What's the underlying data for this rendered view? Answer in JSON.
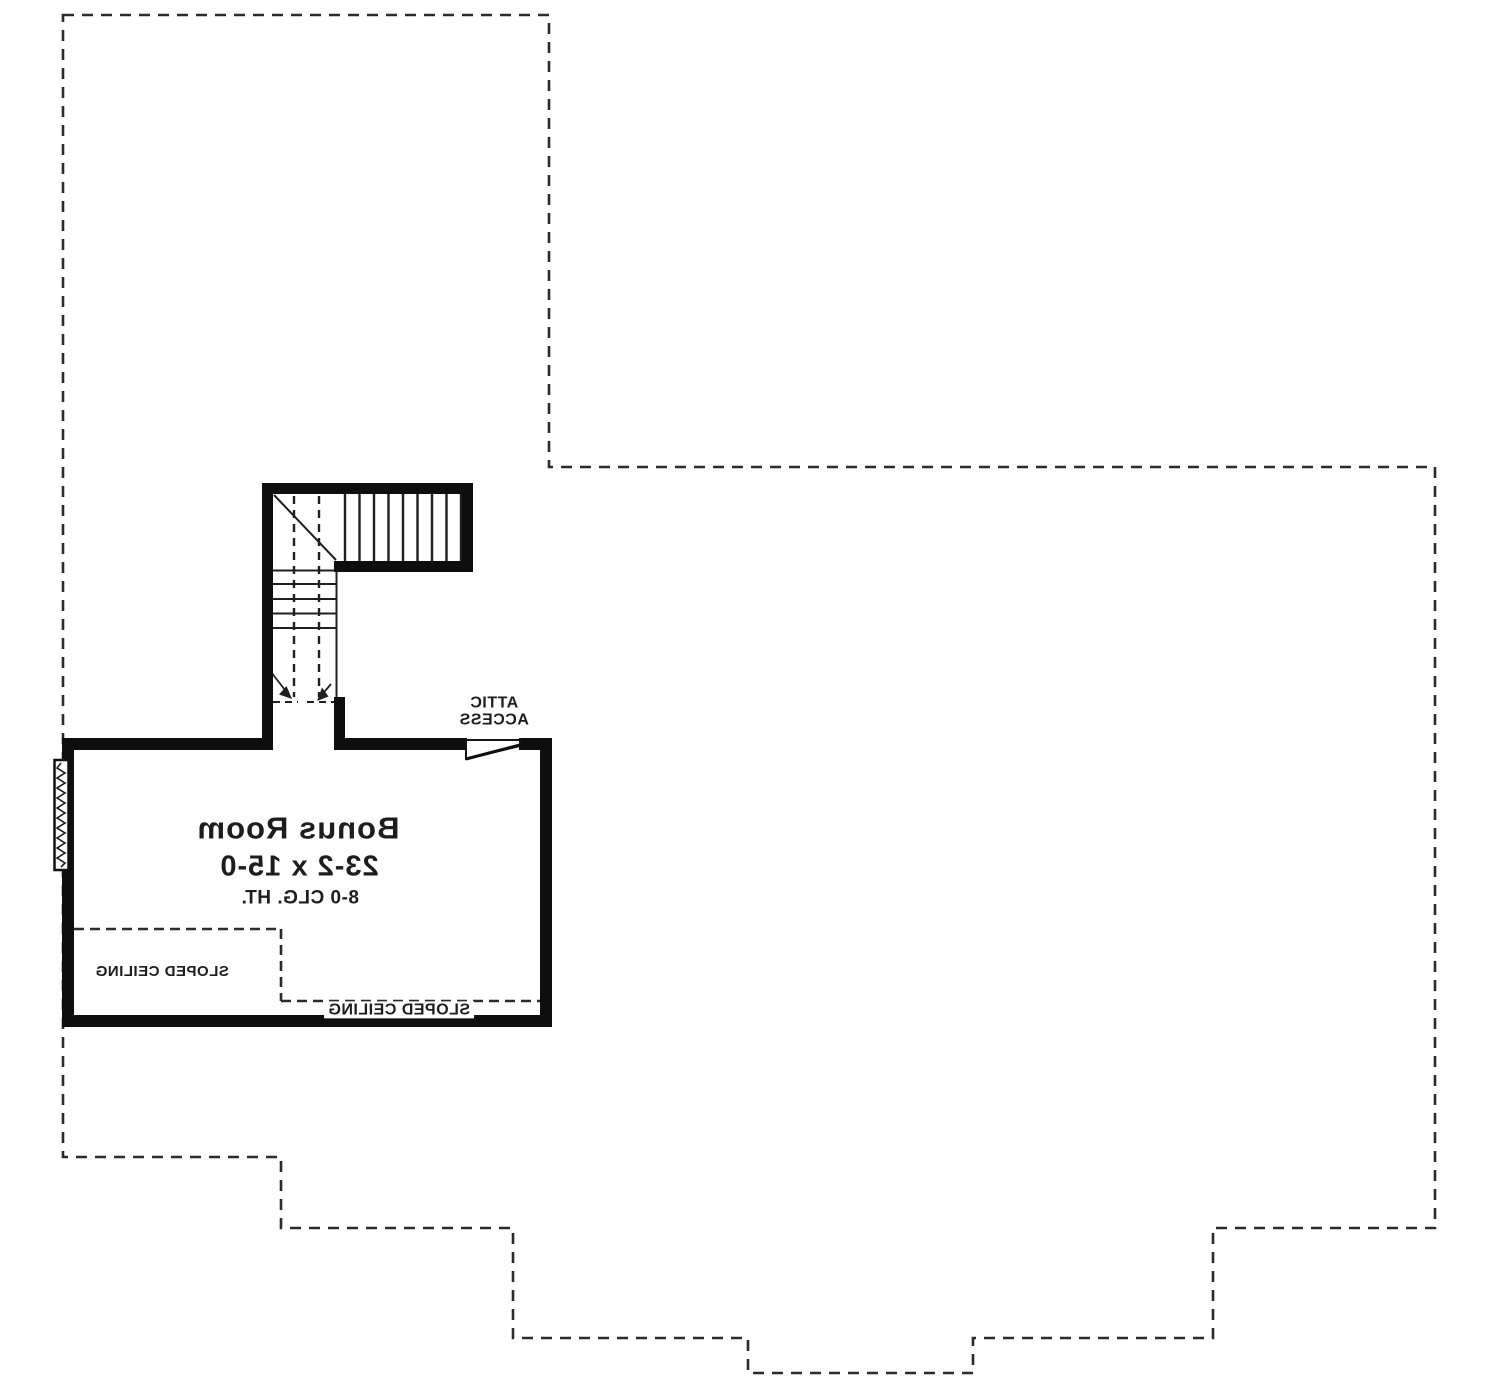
{
  "plan": {
    "labels": {
      "room_name": "Bonus Room",
      "room_dimensions": "23-2 x 15-0",
      "ceiling_height": "8-0 CLG. HT.",
      "attic_access_line1": "ATTIC",
      "attic_access_line2": "ACCESS",
      "sloped_ceiling_left": "SLOPED CEILING",
      "sloped_ceiling_bottom": "SLOPED CEILING"
    },
    "colors": {
      "background": "#ffffff",
      "wall": "#0e0e0e",
      "line": "#1f1f1f",
      "dashed_line": "#2b2b2b",
      "text": "#1d1d1d"
    }
  }
}
